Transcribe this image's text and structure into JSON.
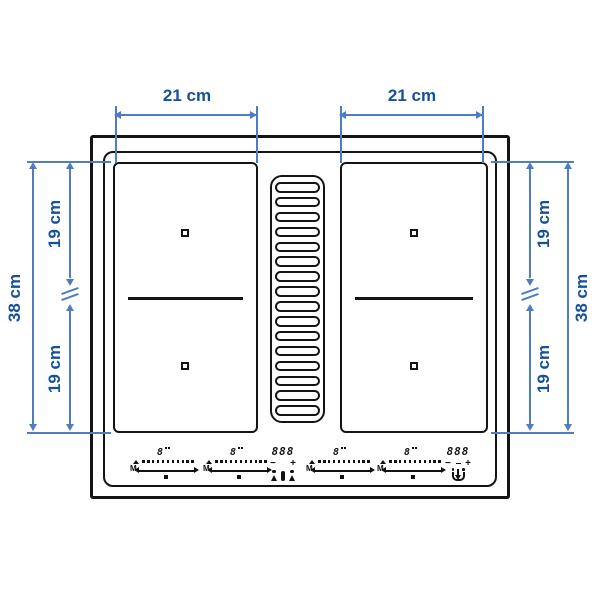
{
  "dimensions": {
    "top_left": "21 cm",
    "top_right": "21 cm",
    "left_upper": "19 cm",
    "left_lower": "19 cm",
    "left_total": "38 cm",
    "right_upper": "19 cm",
    "right_lower": "19 cm",
    "right_total": "38 cm"
  },
  "controls": {
    "mode_label": "M",
    "slider_segments": 11,
    "sliders": [
      {
        "level": "8"
      },
      {
        "level": "8"
      },
      {
        "level": "8"
      },
      {
        "level": "8"
      }
    ],
    "displays": [
      {
        "value": "888",
        "minus": "−",
        "plus": "+"
      },
      {
        "value": "888",
        "minus": "−",
        "plus": "+"
      }
    ]
  },
  "grille": {
    "slat_count": 16
  },
  "colors": {
    "dimension_text": "#15509e",
    "dimension_line": "#4f7dc2",
    "outline": "#141414"
  }
}
